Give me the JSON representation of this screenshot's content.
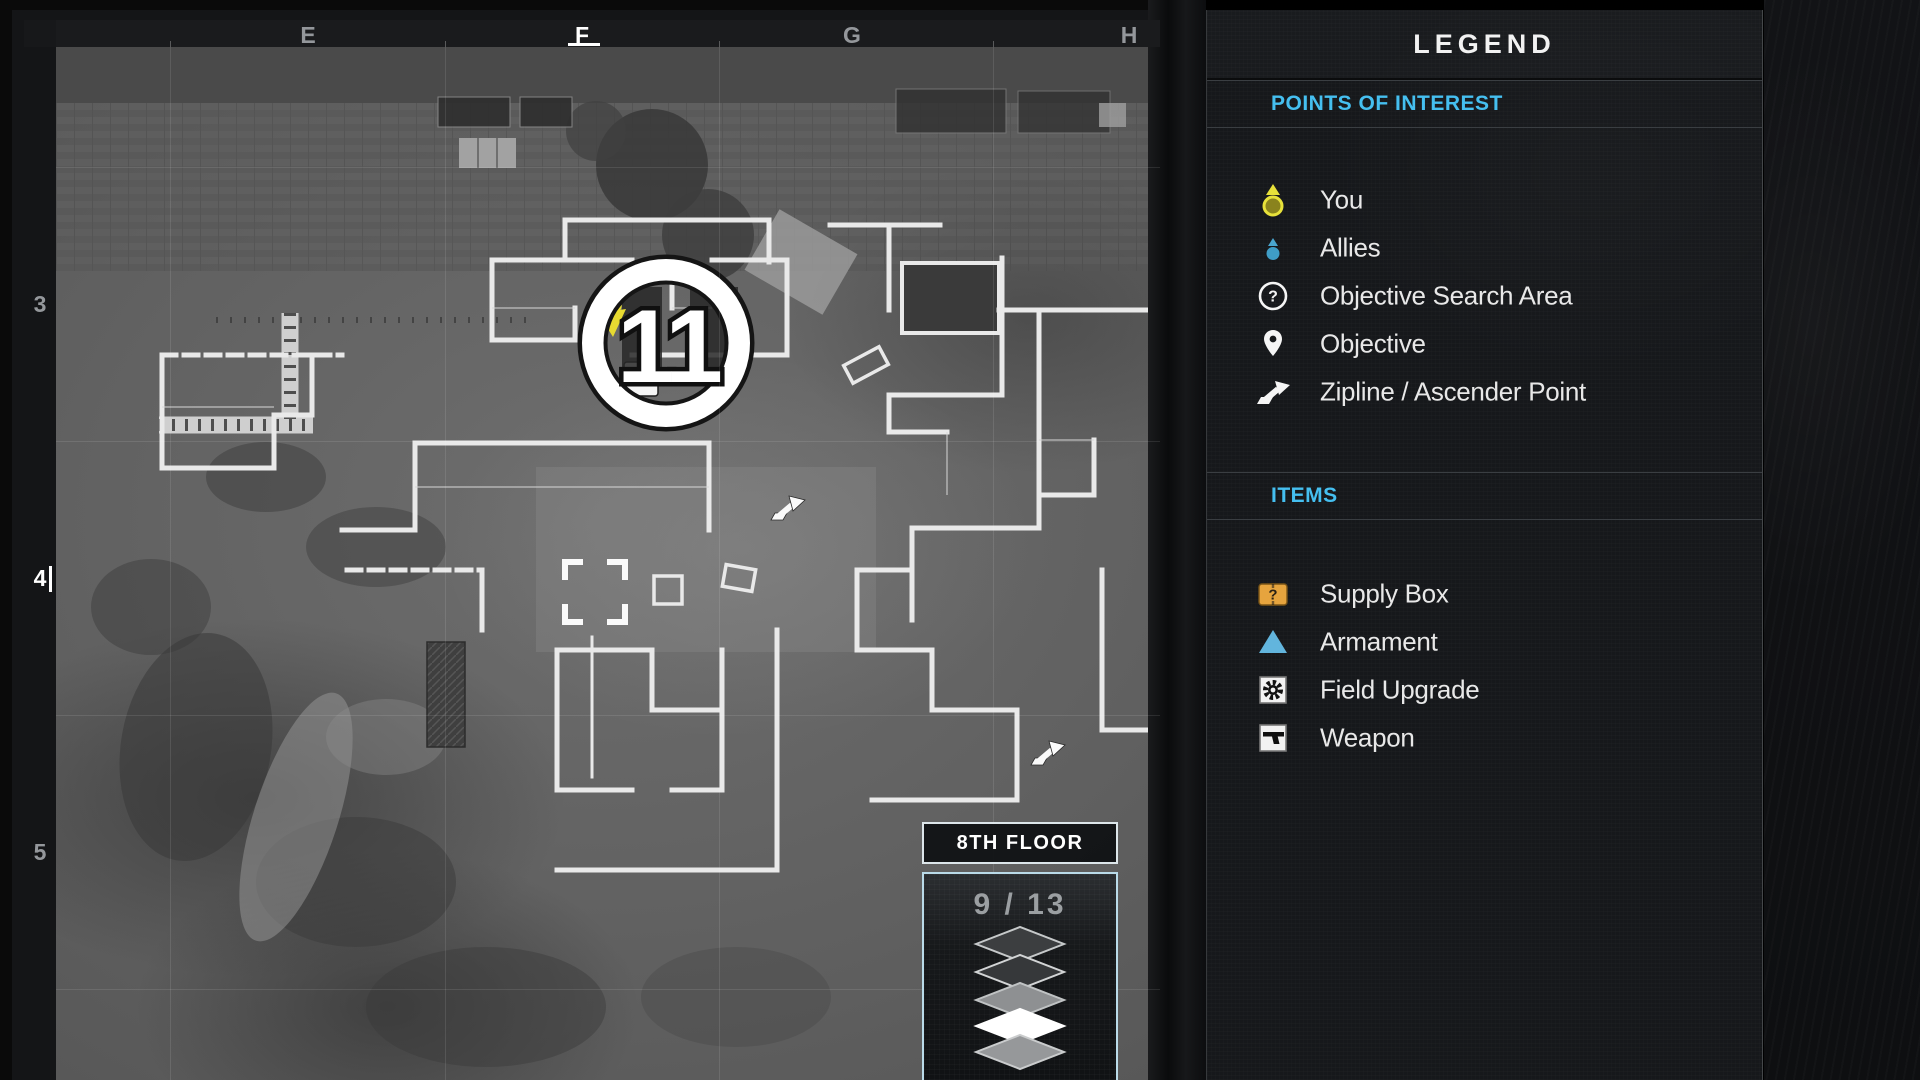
{
  "map_panel": {
    "grid": {
      "columns": [
        "E",
        "F",
        "G",
        "H"
      ],
      "rows": [
        "3",
        "4",
        "5"
      ],
      "active_column": "F",
      "active_row": "4"
    },
    "marker": {
      "number": "11"
    },
    "floor": {
      "label": "8TH FLOOR",
      "indicator": "9 / 13",
      "current_floor": 9,
      "total_floors": 13,
      "stack_layers": [
        "dark",
        "dark",
        "mid-gray",
        "active-white",
        "gray"
      ]
    }
  },
  "legend": {
    "title": "LEGEND",
    "poi": {
      "heading": "POINTS OF INTEREST",
      "rows": [
        {
          "icon": "you-icon",
          "label": "You"
        },
        {
          "icon": "allies-icon",
          "label": "Allies"
        },
        {
          "icon": "objective-search-icon",
          "label": "Objective Search Area",
          "glyph": "?"
        },
        {
          "icon": "objective-pin-icon",
          "label": "Objective"
        },
        {
          "icon": "zipline-icon",
          "label": "Zipline / Ascender Point"
        }
      ]
    },
    "items": {
      "heading": "ITEMS",
      "rows": [
        {
          "icon": "supply-box-icon",
          "label": "Supply Box",
          "glyph": "?"
        },
        {
          "icon": "armament-icon",
          "label": "Armament"
        },
        {
          "icon": "field-upgrade-icon",
          "label": "Field Upgrade"
        },
        {
          "icon": "weapon-icon",
          "label": "Weapon"
        }
      ]
    }
  },
  "colors": {
    "accent_cyan": "#45bff0",
    "you_yellow": "#e7e13a",
    "allies_blue": "#4aa6cf",
    "supply_orange": "#e6a43e",
    "armament_blue": "#62b5dd",
    "wall_white": "#e9e9e9"
  }
}
